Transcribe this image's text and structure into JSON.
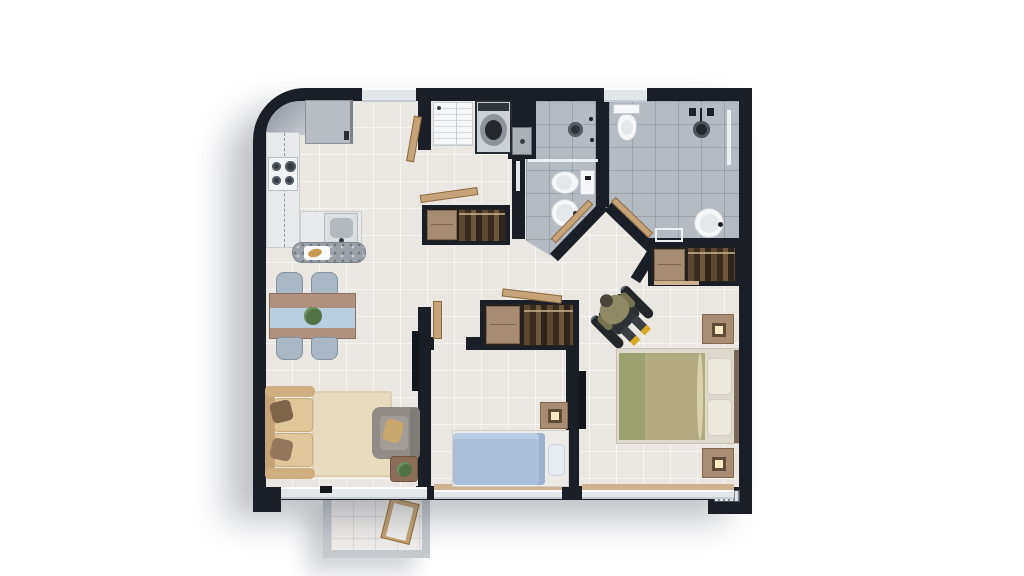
{
  "diagram_type": "apartment-3d-floor-plan-top-view",
  "colors": {
    "wall": "#1a1f27",
    "floor": "#eae6e1",
    "tile": "#b5bbc2",
    "wood": "#c4a478",
    "granite": "#9aa1a8",
    "glass": "#eef2f4",
    "fixture": "#f5f7f8",
    "window": "#e4e7ea",
    "sill": "#cdb392",
    "closet_dark": "#25221d",
    "dresser": "#a58b72",
    "sofa": "#dcbd90",
    "sofa_cushion": "#e0c79a",
    "rug": "#e8dcc0",
    "table_wood": "#ae9181",
    "runner_blue": "#b9cede",
    "chair_gray": "#a9b8c4",
    "blanket_blue": "#abbfda",
    "blanket_olive": "#b3ab80",
    "blanket_olive_dark": "#9ba26d",
    "nightstand": "#a78d73",
    "lamp": "#f7eac2",
    "balcony_wall": "#c5cacf",
    "wheelchair": "#23262b",
    "person_olive": "#8f8a63",
    "shoes_yellow": "#d9a825",
    "tv_black": "#14181d",
    "fridge": "#b8bdc3",
    "plant_green": "#527147"
  },
  "floorplan": {
    "rooms": [
      {
        "name": "Kitchen",
        "furniture": [
          "refrigerator",
          "counter",
          "stove",
          "sink",
          "granite-island"
        ]
      },
      {
        "name": "Laundry",
        "furniture": [
          "utility-sink",
          "washing-machine",
          "vanity-sink"
        ]
      },
      {
        "name": "Bathroom 1",
        "furniture": [
          "shower",
          "toilet",
          "round-sink",
          "glass-partition"
        ]
      },
      {
        "name": "Bathroom 2",
        "furniture": [
          "toilet",
          "shower-head",
          "bench",
          "round-sink",
          "glass-partition"
        ]
      },
      {
        "name": "Living Dining",
        "furniture": [
          "dining-table",
          "four-chairs",
          "plant-centerpiece",
          "tv",
          "sofa",
          "rug",
          "armchair",
          "side-table"
        ]
      },
      {
        "name": "Hallway",
        "furniture": [
          "hall-closet",
          "open-doors"
        ]
      },
      {
        "name": "Bedroom 2",
        "furniture": [
          "closet",
          "single-bed",
          "nightstand-lamp"
        ]
      },
      {
        "name": "Main Bedroom",
        "furniture": [
          "closet",
          "double-bed",
          "two-nightstands",
          "tv",
          "wheelchair-user"
        ]
      },
      {
        "name": "Balcony",
        "furniture": [
          "lounge-chair"
        ]
      }
    ]
  }
}
